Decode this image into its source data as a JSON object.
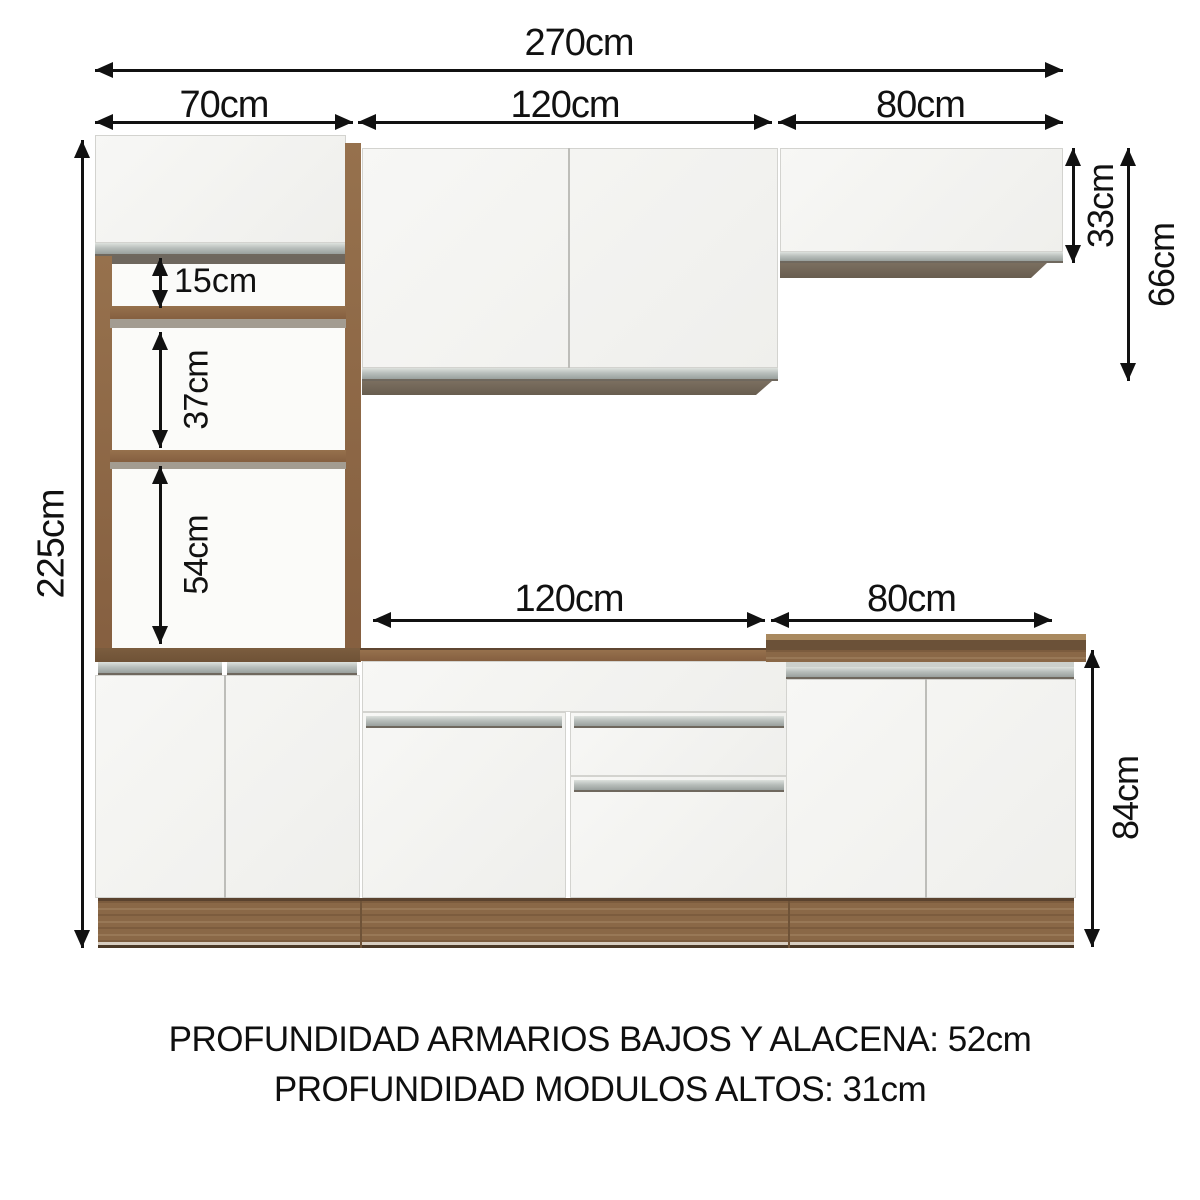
{
  "diagram": {
    "dims": {
      "total_width": "270cm",
      "tall_unit_width": "70cm",
      "upper_mid_width": "120cm",
      "upper_right_width": "80cm",
      "total_height": "225cm",
      "shelf_gap_top": "15cm",
      "shelf_gap_mid": "37cm",
      "shelf_gap_bottom": "54cm",
      "upper_right_height": "33cm",
      "upper_cabinet_height": "66cm",
      "base_mid_width": "120cm",
      "base_right_width": "80cm",
      "base_height": "84cm"
    },
    "footer": {
      "line1": "PROFUNDIDAD ARMARIOS BAJOS Y ALACENA: 52cm",
      "line2": "PROFUNDIDAD MODULOS ALTOS: 31cm"
    },
    "colors": {
      "wood": "#8a6847",
      "wood_dark": "#6b5138",
      "panel_white": "#f3f3f0",
      "handle_gray": "#aab0ad",
      "dimension_black": "#111111"
    }
  }
}
